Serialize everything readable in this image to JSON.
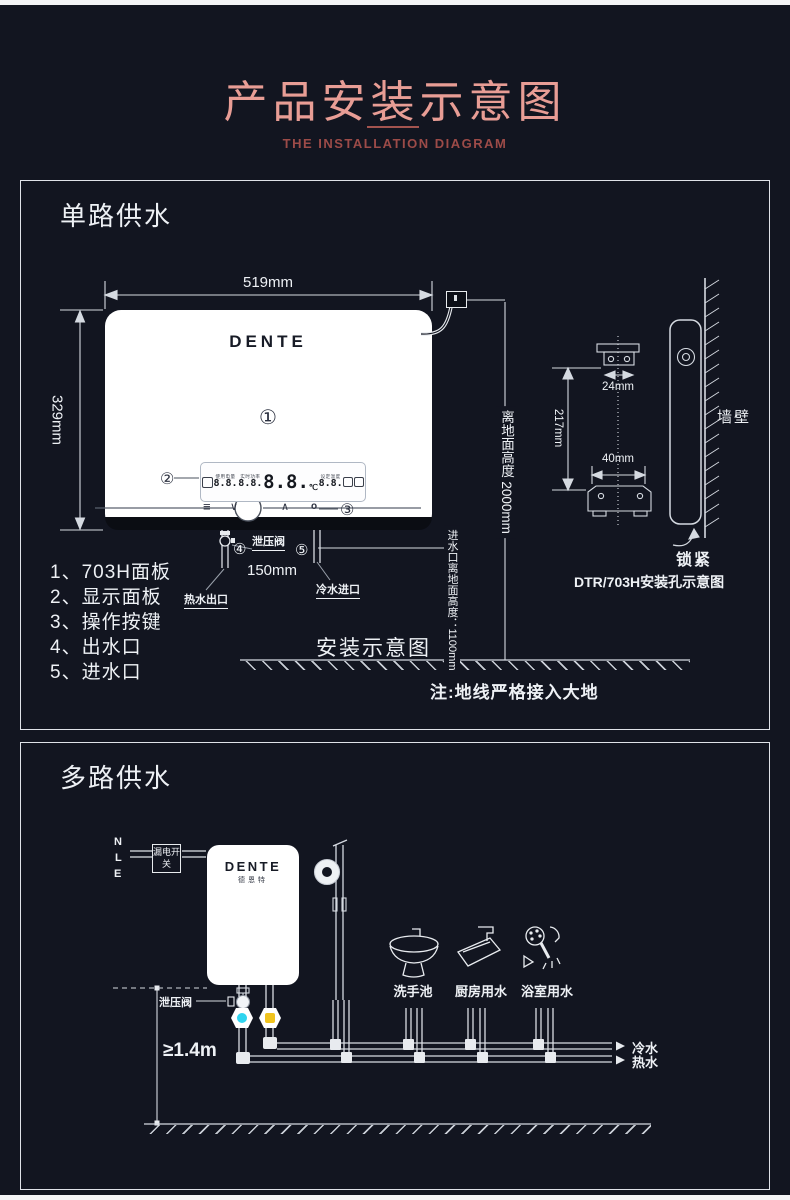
{
  "page": {
    "title": "产品安装示意图",
    "subtitle": "THE INSTALLATION DIAGRAM"
  },
  "colors": {
    "background": "#121520",
    "accent_pink": "#e89d95",
    "subtitle_red": "#9c4b48",
    "line_white": "#d9dde3",
    "valve_cold": "#2fd4ef",
    "valve_hot": "#f0c31e"
  },
  "s1": {
    "heading": "单路供水",
    "brand": "DENTE",
    "dims": {
      "width": "519mm",
      "height": "329mm",
      "pipe_gap": "150mm",
      "wall_height": "离地面高度 2000mm",
      "inlet_height": "进水口离地面高度：1100mm"
    },
    "callouts": [
      "①",
      "②",
      "③",
      "④",
      "⑤"
    ],
    "labels": {
      "relief_valve": "泄压阀",
      "hot_outlet": "热水出口",
      "cold_inlet": "冷水进口",
      "caption": "安装示意图",
      "ground_note": "注:地线严格接入大地"
    },
    "parts": [
      "1、703H面板",
      "2、显示面板",
      "3、操作按键",
      "4、出水口",
      "5、进水口"
    ],
    "mounting": {
      "dim_top": "24mm",
      "dim_mid": "217mm",
      "dim_bottom": "40mm",
      "wall": "墙壁",
      "lock": "锁紧",
      "caption": "DTR/703H安装孔示意图"
    },
    "display": {
      "groups": [
        {
          "label": "使用电量",
          "value": "8.8."
        },
        {
          "label": "实时功率",
          "value": "8.8."
        },
        {
          "label": "",
          "value": "8.8.",
          "unit": "℃"
        },
        {
          "label": "设定温度",
          "value": "8.8."
        }
      ],
      "buttons": {
        "menu": "≡",
        "down": "∨",
        "up": "∧",
        "power": "o"
      }
    }
  },
  "s2": {
    "heading": "多路供水",
    "brand": "DENTE",
    "brand_cn": "德恩特",
    "wire_labels": [
      "N",
      "L",
      "E"
    ],
    "breaker": "漏电开关",
    "relief_valve": "泄压阀",
    "min_height": "≥1.4m",
    "fixtures": [
      "洗手池",
      "厨房用水",
      "浴室用水"
    ],
    "pipes": {
      "cold": "冷水",
      "hot": "热水"
    }
  }
}
